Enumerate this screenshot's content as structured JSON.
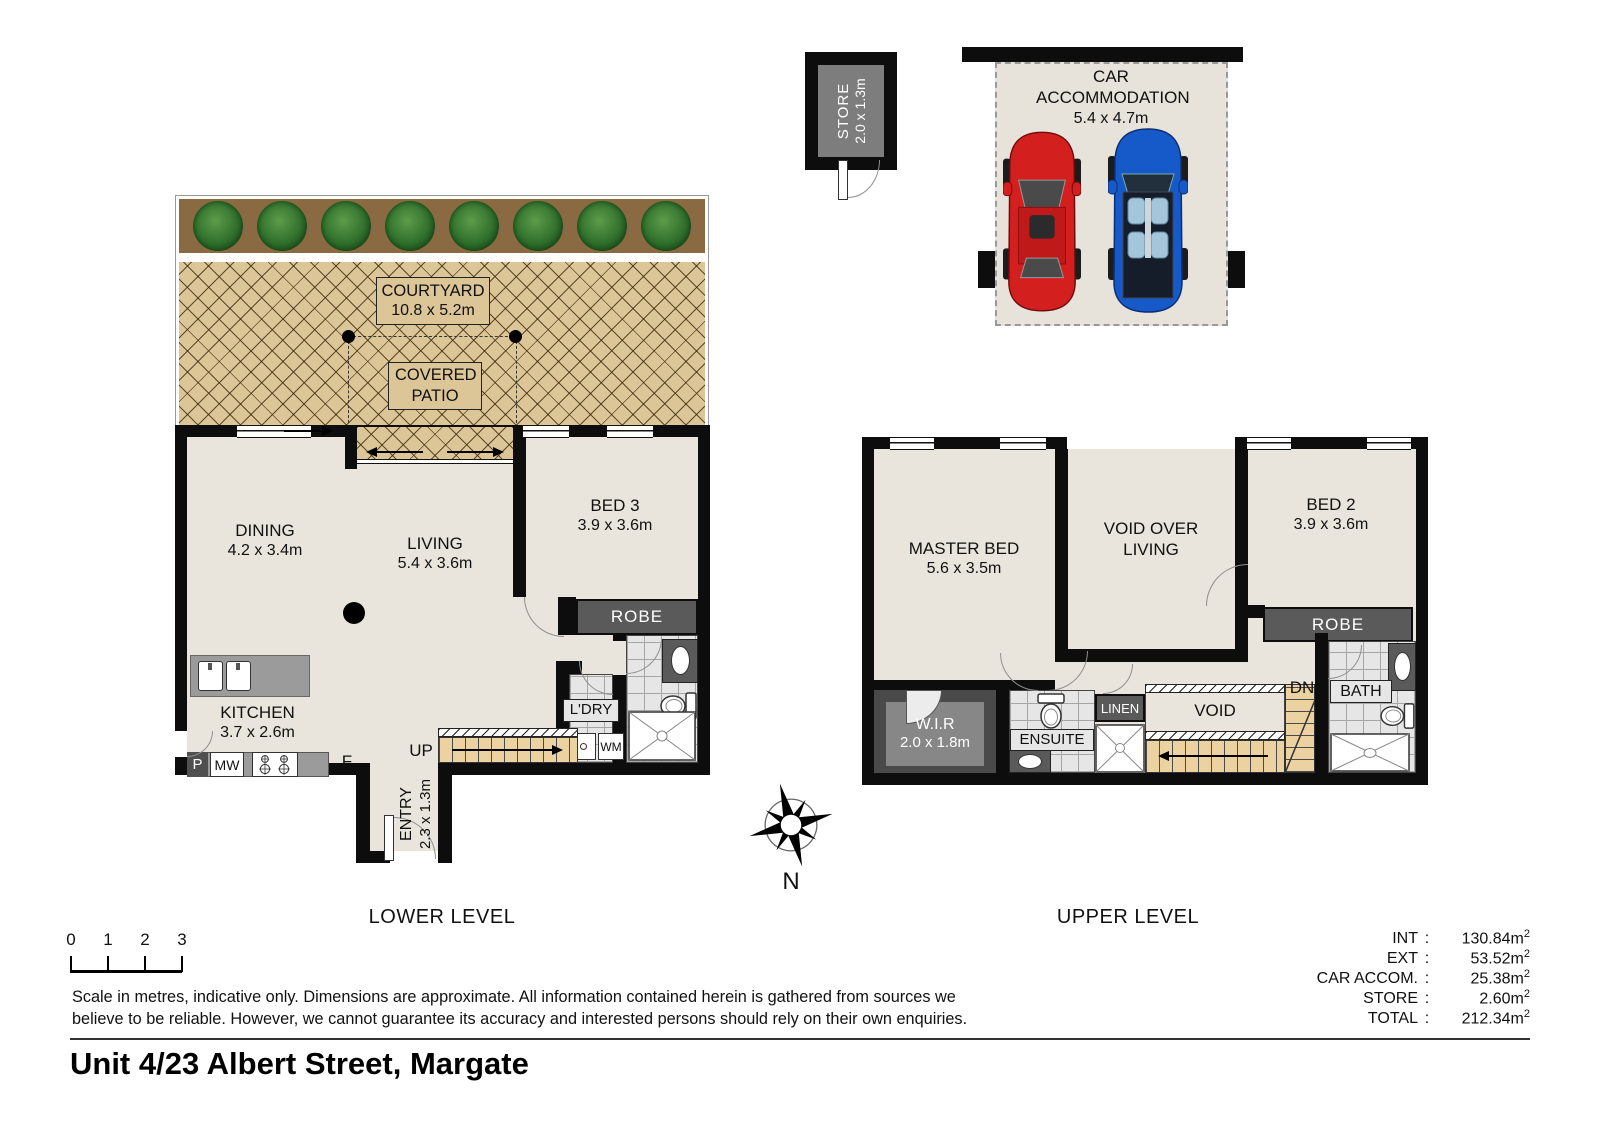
{
  "meta": {
    "address": "Unit 4/23 Albert Street, Margate"
  },
  "levels": {
    "lower": "LOWER LEVEL",
    "upper": "UPPER LEVEL"
  },
  "rooms": {
    "courtyard": {
      "label": "COURTYARD",
      "dims": "10.8 x 5.2m"
    },
    "covered_patio": {
      "label": "COVERED PATIO"
    },
    "dining": {
      "label": "DINING",
      "dims": "4.2 x 3.4m"
    },
    "living": {
      "label": "LIVING",
      "dims": "5.4 x 3.6m"
    },
    "bed3": {
      "label": "BED 3",
      "dims": "3.9 x 3.6m"
    },
    "kitchen": {
      "label": "KITCHEN",
      "dims": "3.7 x 2.6m"
    },
    "ldry": {
      "label": "L'DRY"
    },
    "entry": {
      "label": "ENTRY",
      "dims": "2.3 x 1.3m"
    },
    "robe_lower": {
      "label": "ROBE"
    },
    "master_bed": {
      "label": "MASTER BED",
      "dims": "5.6 x 3.5m"
    },
    "void_over_living": {
      "label": "VOID OVER LIVING"
    },
    "bed2": {
      "label": "BED 2",
      "dims": "3.9 x 3.6m"
    },
    "robe_upper": {
      "label": "ROBE"
    },
    "wir": {
      "label": "W.I.R",
      "dims": "2.0 x 1.8m"
    },
    "ensuite": {
      "label": "ENSUITE"
    },
    "linen": {
      "label": "LINEN"
    },
    "void": {
      "label": "VOID"
    },
    "bath": {
      "label": "BATH"
    },
    "store": {
      "label": "STORE",
      "dims": "2.0 x 1.3m"
    },
    "car_accommodation": {
      "label": "CAR ACCOMMODATION",
      "dims": "5.4 x 4.7m"
    }
  },
  "markers": {
    "up": "UP",
    "dn": "DN",
    "fridge": "F",
    "pantry": "P",
    "microwave": "MW",
    "washing_machine": "WM",
    "north": "N"
  },
  "scale_bar": {
    "ticks": [
      "0",
      "1",
      "2",
      "3"
    ]
  },
  "disclaimer": {
    "line1": "Scale in metres, indicative only. Dimensions are approximate. All information contained herein is gathered from sources we",
    "line2": "believe to be reliable. However, we cannot guarantee its accuracy and interested persons should rely on their own enquiries."
  },
  "areas": {
    "separator": ":",
    "unit_base": "m",
    "unit_sup": "2",
    "rows": [
      {
        "label": "INT",
        "value": "130.84"
      },
      {
        "label": "EXT",
        "value": "53.52"
      },
      {
        "label": "CAR ACCOM.",
        "value": "25.38"
      },
      {
        "label": "STORE",
        "value": "2.60"
      },
      {
        "label": "TOTAL",
        "value": "212.34"
      }
    ]
  }
}
